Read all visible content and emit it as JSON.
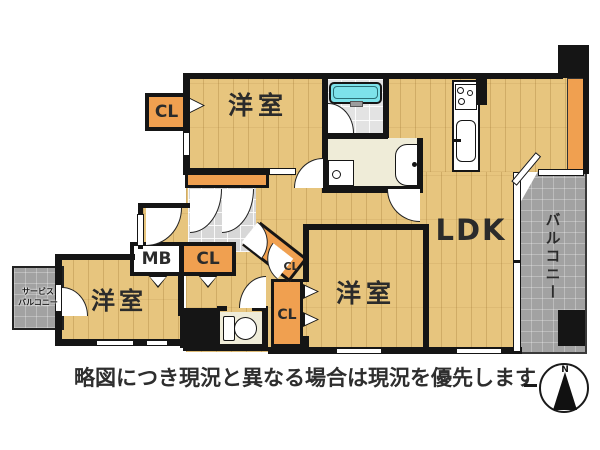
{
  "rooms": {
    "bedroom_top": {
      "label": "洋室"
    },
    "bedroom_left": {
      "label": "洋室"
    },
    "bedroom_center": {
      "label": "洋室"
    },
    "ldk": {
      "label": "LDK"
    },
    "balcony": {
      "label": "バルコニー"
    },
    "service_balcony": {
      "line1": "サービス",
      "line2": "バルコニー"
    }
  },
  "storage": {
    "closet_top_left": "CL",
    "closet_hall": "CL",
    "closet_diagonal": "CL",
    "closet_center": "CL",
    "meter_box": "MB"
  },
  "footer": {
    "disclaimer": "略図につき現況と異なる場合は現況を優先します"
  },
  "compass": {
    "north_label": "N"
  },
  "colors": {
    "floor_wood": "#e7c57e",
    "closet_orange": "#f0a050",
    "balcony_gray": "#a2a2a2",
    "entrance_tile": "#d7d7d7",
    "bath_tub_cyan": "#7de2ea",
    "wall_black": "#151515",
    "utility_cream": "#efecd8"
  }
}
